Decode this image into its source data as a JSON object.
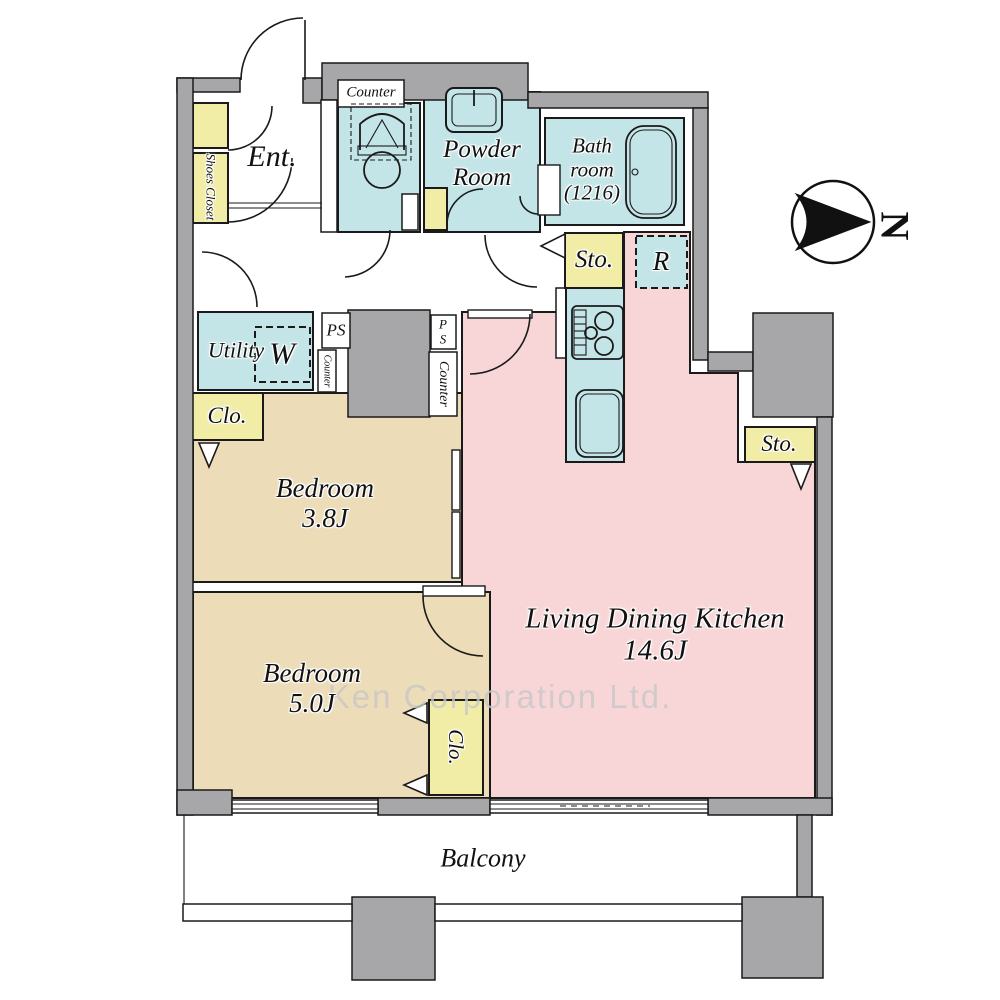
{
  "plan_type": "floor-plan",
  "rooms": {
    "entrance": {
      "label": "Ent."
    },
    "powder_room": {
      "label": "Powder Room"
    },
    "bathroom": {
      "label": "Bath room",
      "size": "(1216)"
    },
    "utility": {
      "label": "Utility"
    },
    "bedroom_a": {
      "label": "Bedroom",
      "size": "3.8J"
    },
    "bedroom_b": {
      "label": "Bedroom",
      "size": "5.0J"
    },
    "ldk": {
      "label": "Living Dining Kitchen",
      "size": "14.6J"
    },
    "balcony": {
      "label": "Balcony"
    }
  },
  "fixtures": {
    "shoes_closet": "Shoes Closet",
    "counter_toilet": "Counter",
    "counter_a": "Counter",
    "counter_b": "Counter",
    "pipe_space_a": "PS",
    "pipe_space_b": "PS",
    "washer": "W",
    "refrigerator": "R",
    "storage_a": "Sto.",
    "storage_b": "Sto.",
    "closet_a": "Clo.",
    "closet_b": "Clo."
  },
  "compass": {
    "label": "N"
  },
  "watermark": "Ken Corporation Ltd.",
  "colors": {
    "wet_area": "#c4e5e7",
    "storage": "#f1eda6",
    "living": "#f8d6d8",
    "bedroom": "#ecdcb8",
    "wall": "#a7a7aa",
    "outline": "#1a1a1a",
    "watermark": "#c8c8c8"
  }
}
